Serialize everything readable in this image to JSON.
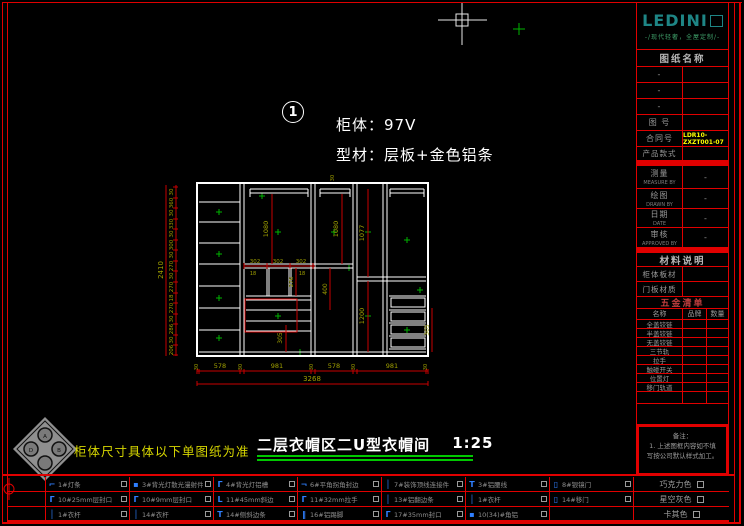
{
  "logo": {
    "name": "LEDINI",
    "tagline": "-/现代轻奢，全屋定制/-"
  },
  "titleblock": {
    "drawing_name_header": "图纸名称",
    "blank_rows": [
      "-",
      "-",
      "-"
    ],
    "drawing_no_label": "图 号",
    "contract_no_label": "合同号",
    "contract_no_value": "LDR10-ZXZT001-07",
    "product_style_label": "产品款式",
    "measure_label": "测量",
    "measure_sub": "MEASURE BY",
    "measure_value": "-",
    "draw_label": "绘图",
    "draw_sub": "DRAWN BY",
    "draw_value": "-",
    "date_label": "日期",
    "date_sub": "DATE",
    "date_value": "-",
    "approve_label": "审核",
    "approve_sub": "APPROVED BY",
    "approve_value": "-",
    "material_header": "材料说明",
    "cabinet_board_label": "柜体板材",
    "door_board_label": "门板材质",
    "hardware_header": "五金清单",
    "hw_col_name": "名称",
    "hw_col_brand": "品牌",
    "hw_col_qty": "数量",
    "hardware_items": [
      "全盖铰链",
      "半盖铰链",
      "无盖铰链",
      "三节轨",
      "拉手",
      "触碰开关",
      "位置灯",
      "移门轨道"
    ],
    "notes_title": "备注：",
    "notes_line1": "1. 上述图框内容如不填",
    "notes_line2": "写按公司默认样式加工。"
  },
  "drawing": {
    "marker_number": "1",
    "cabinet_label": "柜体：97V",
    "profile_label": "型材：层板+金色铝条",
    "total_height": "2410",
    "total_width": "3268",
    "left_chain": [
      "30",
      "360",
      "30",
      "330",
      "30",
      "300",
      "30",
      "270",
      "30",
      "270",
      "18",
      "270",
      "30",
      "286",
      "30",
      "206"
    ],
    "bottom_chain": [
      "30",
      "578",
      "30",
      "981",
      "30",
      "578",
      "30",
      "981",
      "30"
    ],
    "inner_dims": [
      "1080",
      "1080",
      "1077",
      "1200",
      "302",
      "302",
      "302",
      "18",
      "18",
      "276",
      "400",
      "305",
      "305",
      "30"
    ]
  },
  "footer": {
    "note": "柜体尺寸具体以下单图纸为准",
    "title": "二层衣帽区二U型衣帽间",
    "scale": "1:25"
  },
  "legend": {
    "rows": [
      {
        "items": [
          {
            "icon": "⌐",
            "label": "1#灯条"
          },
          {
            "icon": "▪",
            "label": "3#背光灯散光漫射件"
          },
          {
            "icon": "Г",
            "label": "4#背光灯铝槽"
          },
          {
            "icon": "¬",
            "label": "6#平角拐角封边"
          },
          {
            "icon": "│",
            "label": "7#装饰顶线连接件"
          },
          {
            "icon": "Т",
            "label": "3#铝腰线"
          },
          {
            "icon": "▯",
            "label": "8#银镜门"
          }
        ],
        "color_option": "巧克力色"
      },
      {
        "items": [
          {
            "icon": "Г",
            "label": "10#25mm层封口"
          },
          {
            "icon": "Г",
            "label": "10#9mm层封口"
          },
          {
            "icon": "L",
            "label": "11#45mm斜边"
          },
          {
            "icon": "Г",
            "label": "11#32mm拉手"
          },
          {
            "icon": "│",
            "label": "13#铝翻边条"
          },
          {
            "icon": "│",
            "label": "1#衣杆"
          },
          {
            "icon": "▯",
            "label": "14#移门"
          }
        ],
        "color_option": "星空灰色"
      },
      {
        "items": [
          {
            "icon": "│",
            "label": "1#衣杆"
          },
          {
            "icon": "│",
            "label": "14#衣杆"
          },
          {
            "icon": "Т",
            "label": "14#侧斜边条"
          },
          {
            "icon": "‖",
            "label": "16#铝踢脚"
          },
          {
            "icon": "Г",
            "label": "17#35mm封口"
          },
          {
            "icon": "▪",
            "label": "10(34)#角铝"
          },
          {
            "icon": "",
            "label": ""
          }
        ],
        "color_option": "卡其色"
      }
    ]
  },
  "ornament": {
    "letters": [
      "A",
      "D",
      "B"
    ]
  },
  "colors": {
    "border_red": "#e00000",
    "dimension_red": "#c80000",
    "dimension_text_olive": "#a0a000",
    "logo_teal": "#1e8585",
    "tagline_green": "#3fa06a",
    "contract_yellow": "#ffff00",
    "note_yellow": "#d6d600",
    "title_underline_green": "#00c800",
    "legend_icon_blue": "#2f7fff",
    "grip_green": "#00b400"
  }
}
